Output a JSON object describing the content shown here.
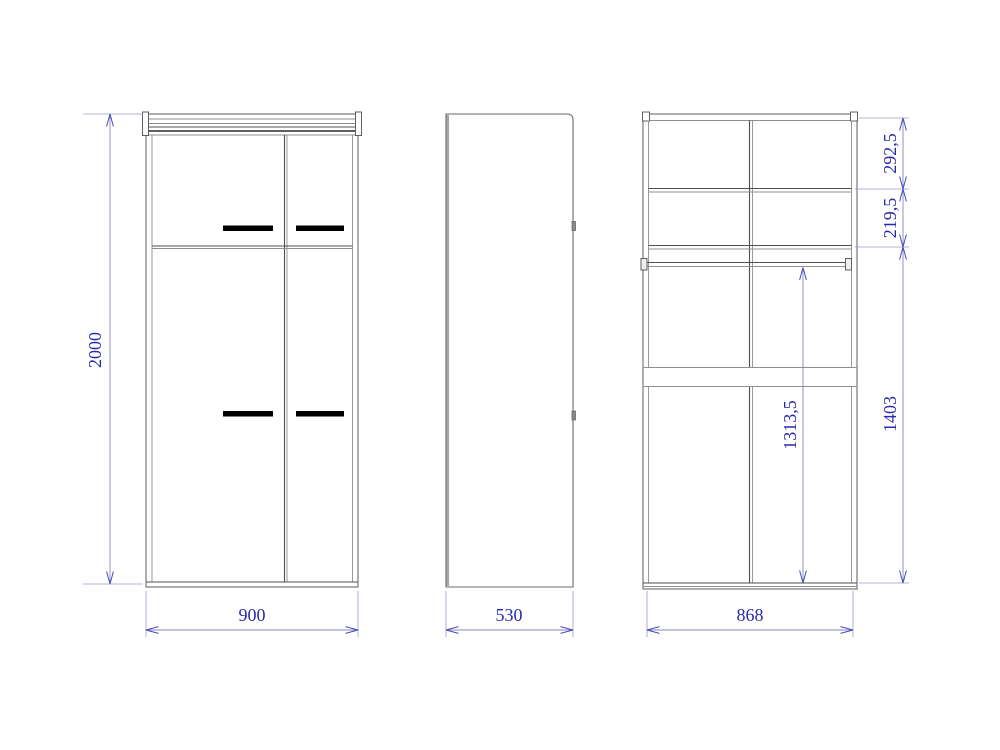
{
  "drawing": {
    "type": "wardrobe-orthographic-views",
    "background": "#ffffff",
    "colors": {
      "outline": "#6b6b6b",
      "outline_dark": "#2a2a2a",
      "panel_shadow": "#a8a8a8",
      "handle": "#000000",
      "dimension_line": "#8585c6",
      "dimension_text": "#2929ad"
    }
  },
  "dims": {
    "front_height": "2000",
    "front_width": "900",
    "side_depth": "530",
    "internal_width": "868",
    "section_top": "292,5",
    "section_shelf": "219,5",
    "section_bottom": "1403",
    "rod_to_bottom": "1313,5"
  }
}
